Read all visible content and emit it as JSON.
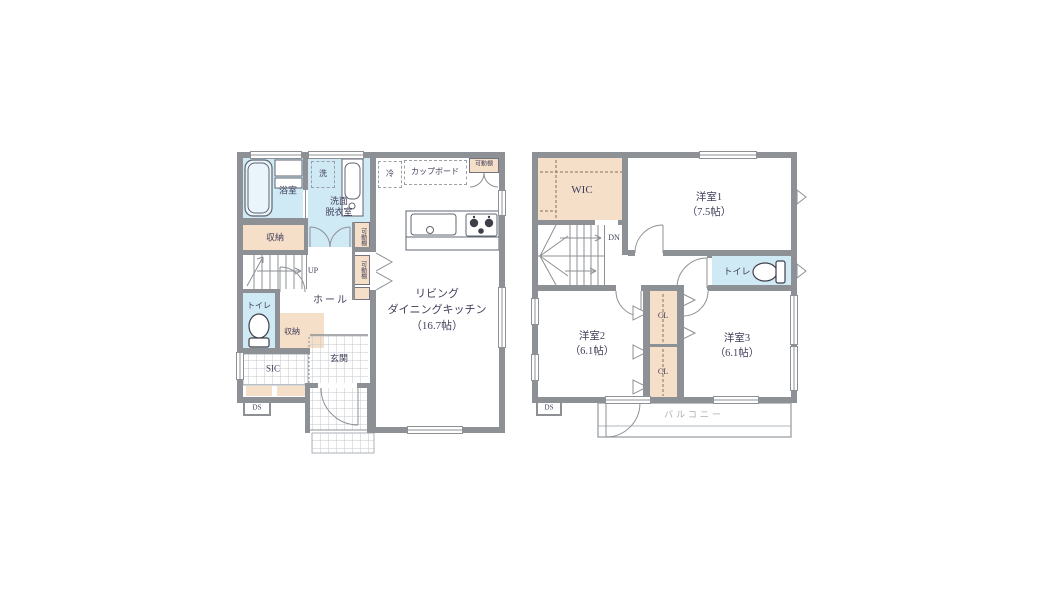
{
  "colors": {
    "wall": "#8d9095",
    "room_blue": "#cfe9f5",
    "room_beige": "#f6dfc9",
    "text": "#3f3f5a",
    "balcony_text": "#a9adb3"
  },
  "floor1": {
    "bath": "浴室",
    "washroom": "洗面\n脱衣室",
    "washer": "洗",
    "fridge": "冷",
    "cupboard": "カップボード",
    "movable_shelf": "可動棚",
    "storage": "収納",
    "storage2": "収納",
    "up": "UP",
    "toilet": "トイレ",
    "hall": "ホール",
    "sic": "SIC",
    "entrance": "玄関",
    "ds": "DS",
    "ldk": "リビング\nダイニングキッチン\n（16.7帖）"
  },
  "floor2": {
    "wic": "WIC",
    "room1": "洋室1\n（7.5帖）",
    "dn": "DN",
    "toilet": "トイレ",
    "room2": "洋室2\n（6.1帖）",
    "closet": "CL",
    "room3": "洋室3\n（6.1帖）",
    "balcony": "バルコニー",
    "ds": "DS"
  }
}
